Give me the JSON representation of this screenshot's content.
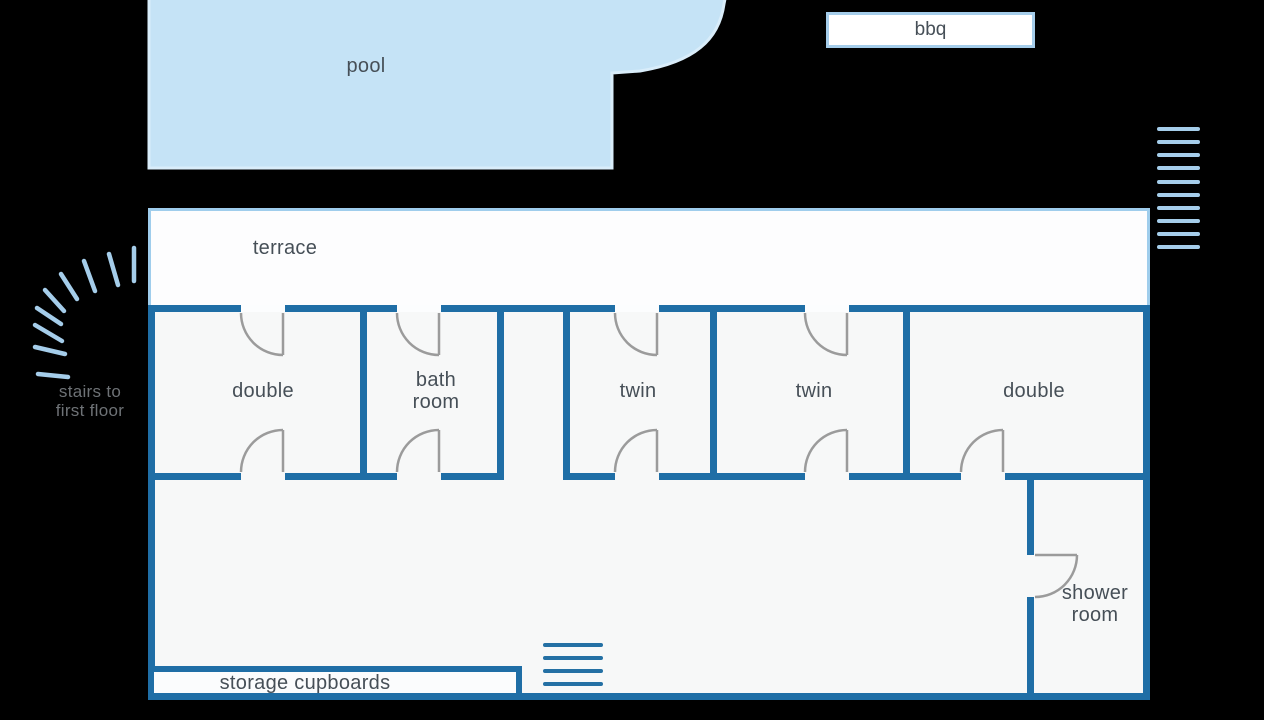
{
  "pool": {
    "label": "pool"
  },
  "bbq": {
    "label": "bbq"
  },
  "terrace": {
    "label": "terrace"
  },
  "stairs_outdoor": {
    "label_line1": "stairs to",
    "label_line2": "first floor"
  },
  "rooms": {
    "double_left": {
      "label": "double"
    },
    "bathroom": {
      "label_line1": "bath",
      "label_line2": "room"
    },
    "twin_left": {
      "label": "twin"
    },
    "twin_right": {
      "label": "twin"
    },
    "double_right": {
      "label": "double"
    },
    "shower": {
      "label_line1": "shower",
      "label_line2": "room"
    },
    "storage": {
      "label": "storage cupboards"
    }
  },
  "colors": {
    "background": "#000000",
    "wall": "#1f6ea6",
    "room_fill": "#f7f8f8",
    "terrace_fill": "#fdfdfe",
    "terrace_border": "#9fcdec",
    "pool_fill": "#c5e3f6",
    "pool_border": "#d9edfa",
    "accent_light": "#a5cdea",
    "door_arc": "#9b9b9b",
    "label_text": "#464f57"
  }
}
